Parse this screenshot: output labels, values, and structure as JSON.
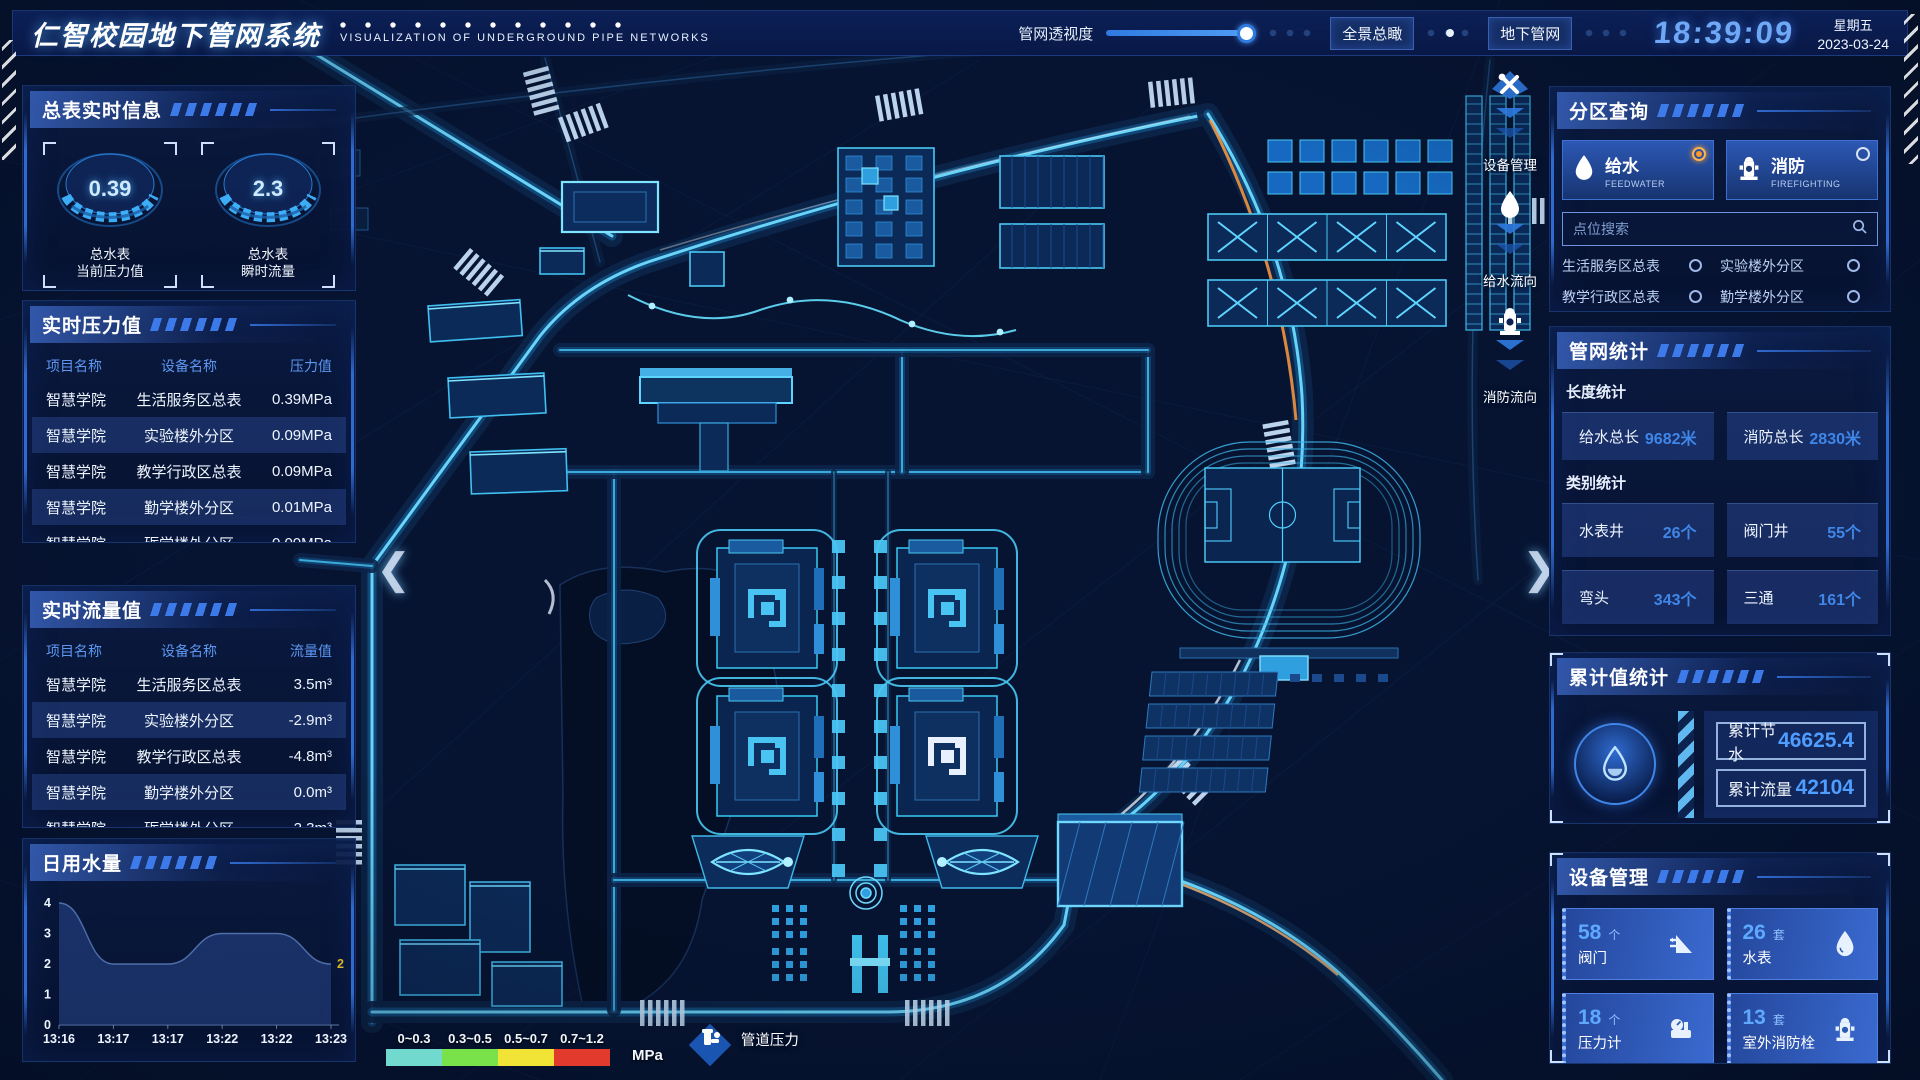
{
  "header": {
    "title": "仁智校园地下管网系统",
    "subtitle": "VISUALIZATION OF UNDERGROUND PIPE NETWORKS",
    "opacity_label": "管网透视度",
    "btn_panorama": "全景总瞰",
    "btn_underground": "地下管网",
    "time": "18:39:09",
    "weekday": "星期五",
    "date": "2023-03-24"
  },
  "left": {
    "meters": {
      "title": "总表实时信息",
      "gauges": [
        {
          "value": "0.39",
          "label1": "总水表",
          "label2": "当前压力值"
        },
        {
          "value": "2.3",
          "label1": "总水表",
          "label2": "瞬时流量"
        }
      ]
    },
    "pressure": {
      "title": "实时压力值",
      "headers": [
        "项目名称",
        "设备名称",
        "压力值"
      ],
      "rows": [
        [
          "智慧学院",
          "生活服务区总表",
          "0.39MPa"
        ],
        [
          "智慧学院",
          "实验楼外分区",
          "0.09MPa"
        ],
        [
          "智慧学院",
          "教学行政区总表",
          "0.09MPa"
        ],
        [
          "智慧学院",
          "勤学楼外分区",
          "0.01MPa"
        ],
        [
          "智慧学院",
          "砺学楼外分区",
          "0.00MPa"
        ]
      ]
    },
    "flow": {
      "title": "实时流量值",
      "headers": [
        "项目名称",
        "设备名称",
        "流量值"
      ],
      "rows": [
        [
          "智慧学院",
          "生活服务区总表",
          "3.5m³"
        ],
        [
          "智慧学院",
          "实验楼外分区",
          "-2.9m³"
        ],
        [
          "智慧学院",
          "教学行政区总表",
          "-4.8m³"
        ],
        [
          "智慧学院",
          "勤学楼外分区",
          "0.0m³"
        ],
        [
          "智慧学院",
          "砺学楼外分区",
          "2.3m³"
        ]
      ]
    },
    "daily": {
      "title": "日用水量"
    }
  },
  "chart_data": {
    "type": "area",
    "title": "日用水量",
    "x": [
      "13:16",
      "13:17",
      "13:17",
      "13:22",
      "13:22",
      "13:23"
    ],
    "values": [
      4,
      2,
      2,
      3,
      3,
      2
    ],
    "ylim": [
      0,
      4
    ],
    "yticks": [
      0,
      1,
      2,
      3,
      4
    ],
    "end_label": "2",
    "xlabel": "",
    "ylabel": "",
    "legend_position": "none",
    "grid": false
  },
  "right": {
    "zone": {
      "title": "分区查询",
      "feedwater": {
        "cn": "给水",
        "en": "FEEDWATER",
        "selected": true
      },
      "firefighting": {
        "cn": "消防",
        "en": "FIREFIGHTING",
        "selected": false
      },
      "search_placeholder": "点位搜索",
      "items": [
        "生活服务区总表",
        "实验楼外分区",
        "教学行政区总表",
        "勤学楼外分区",
        "砺学楼外分区",
        "宿舍区泵房"
      ]
    },
    "stats": {
      "title": "管网统计",
      "length_label": "长度统计",
      "length": [
        {
          "name": "给水总长",
          "value": "9682米"
        },
        {
          "name": "消防总长",
          "value": "2830米"
        }
      ],
      "category_label": "类别统计",
      "category": [
        {
          "name": "水表井",
          "value": "26个"
        },
        {
          "name": "阀门井",
          "value": "55个"
        },
        {
          "name": "弯头",
          "value": "343个"
        },
        {
          "name": "三通",
          "value": "161个"
        }
      ]
    },
    "cumulative": {
      "title": "累计值统计",
      "rows": [
        {
          "name": "累计节水",
          "value": "46625.4"
        },
        {
          "name": "累计流量",
          "value": "42104"
        }
      ]
    },
    "devices": {
      "title": "设备管理",
      "cards": [
        {
          "count": "58",
          "unit": "个",
          "name": "阀门"
        },
        {
          "count": "26",
          "unit": "套",
          "name": "水表"
        },
        {
          "count": "18",
          "unit": "个",
          "name": "压力计"
        },
        {
          "count": "13",
          "unit": "套",
          "name": "室外消防栓"
        }
      ]
    }
  },
  "map": {
    "controls": [
      {
        "label": "设备管理"
      },
      {
        "label": "给水流向"
      },
      {
        "label": "消防流向"
      }
    ],
    "legend": {
      "ranges": [
        "0~0.3",
        "0.3~0.5",
        "0.5~0.7",
        "0.7~1.2"
      ],
      "colors": [
        "#72d9cf",
        "#79e24a",
        "#f2e436",
        "#e23b2e"
      ],
      "unit": "MPa",
      "label": "管道压力"
    }
  },
  "colors": {
    "accent": "#2f7ae0",
    "glow": "#63d9ff",
    "value_blue": "#3f86e8"
  }
}
